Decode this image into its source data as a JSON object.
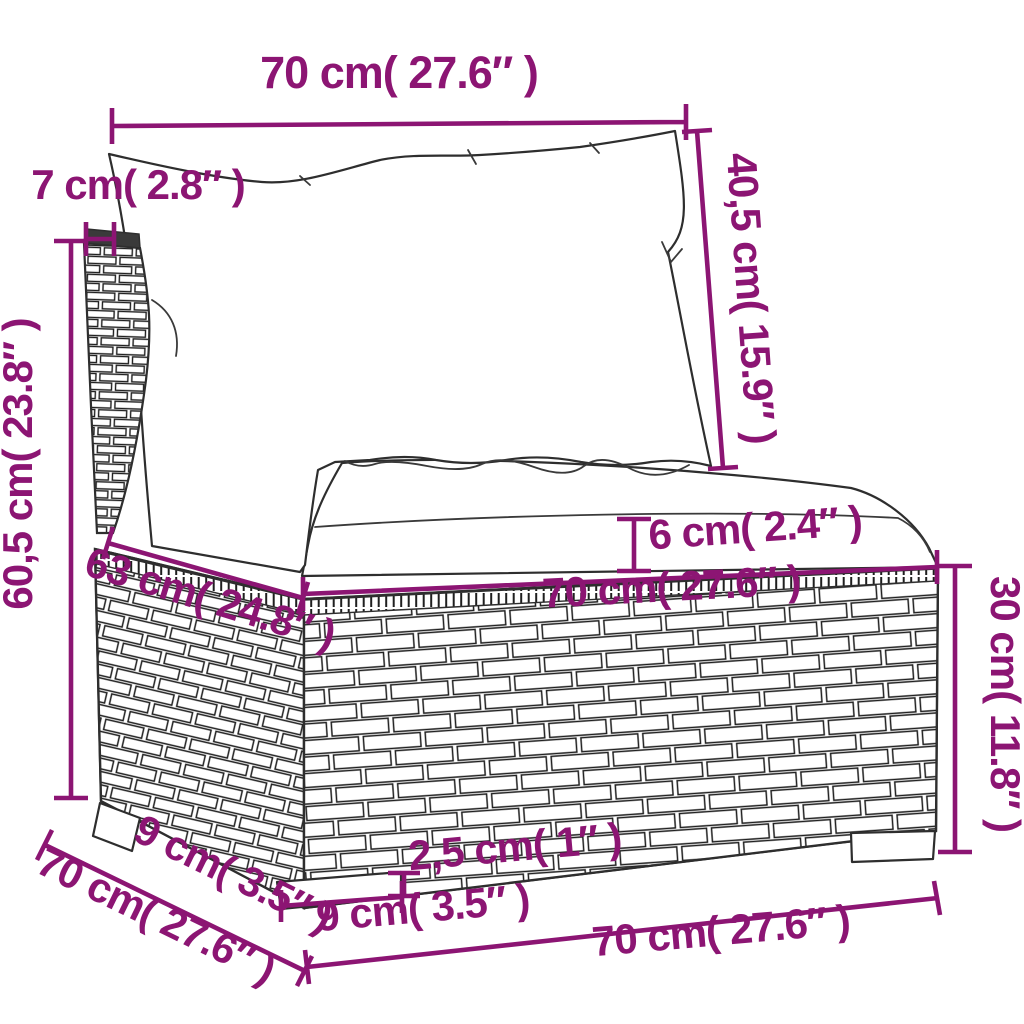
{
  "page": {
    "background": "#ffffff"
  },
  "style": {
    "dimension_color": "#8c1573",
    "outline_color": "#2e2e2e"
  },
  "product": {
    "name": "poly-rattan-sofa-middle-section-with-cushions"
  },
  "dimensions": [
    {
      "id": "back-width",
      "label": "70 cm( 27.6″ )"
    },
    {
      "id": "back-cushion-height",
      "label": "40,5 cm( 15.9″ )"
    },
    {
      "id": "backrest-thickness",
      "label": "7 cm( 2.8″ )"
    },
    {
      "id": "total-height",
      "label": "60,5 cm( 23.8″ )"
    },
    {
      "id": "seat-cushion-thickness",
      "label": "6 cm( 2.4″ )"
    },
    {
      "id": "seat-depth",
      "label": "63 cm( 24.8″ )"
    },
    {
      "id": "seat-width",
      "label": "70 cm( 27.6″ )"
    },
    {
      "id": "base-height",
      "label": "30 cm( 11.8″ )"
    },
    {
      "id": "foot-height",
      "label": "2,5 cm( 1″ )"
    },
    {
      "id": "foot-depth-side",
      "label": "9 cm( 3.5″ )"
    },
    {
      "id": "total-depth",
      "label": "70 cm( 27.6″ )"
    },
    {
      "id": "foot-width-front",
      "label": "9 cm( 3.5″ )"
    },
    {
      "id": "total-width",
      "label": "70 cm( 27.6″ )"
    }
  ]
}
